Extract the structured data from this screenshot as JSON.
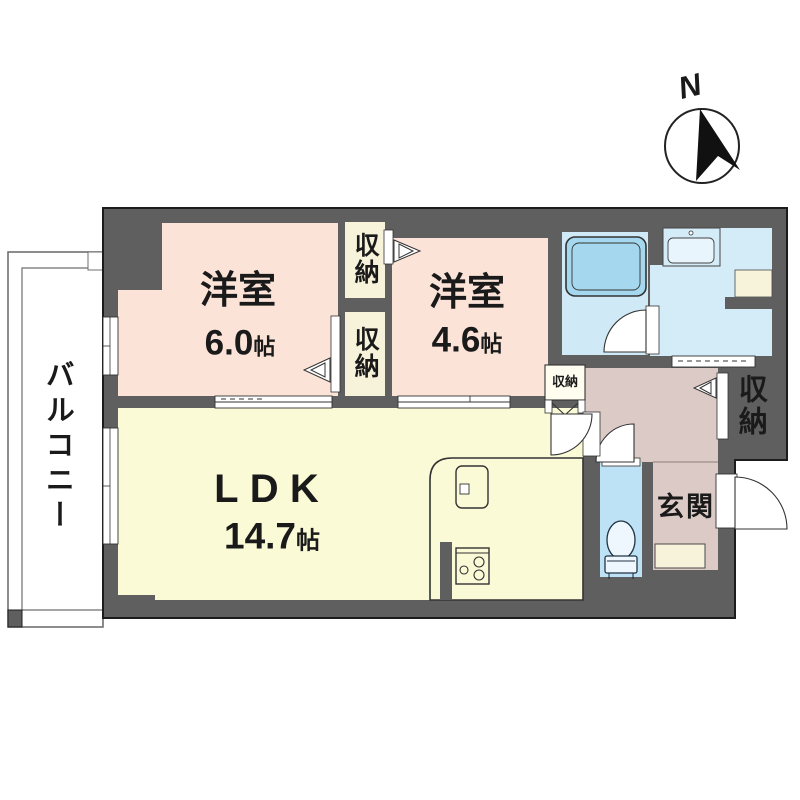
{
  "compass": {
    "label": "N"
  },
  "rooms": {
    "balcony": {
      "label": "バルコニー"
    },
    "bedroom_west_1": {
      "label": "洋室",
      "size": "6.0",
      "unit": "帖"
    },
    "bedroom_west_2": {
      "label": "洋室",
      "size": "4.6",
      "unit": "帖"
    },
    "ldk": {
      "label": "LDK",
      "size": "14.7",
      "unit": "帖"
    },
    "entrance": {
      "label": "玄関"
    },
    "closet_between_top": {
      "label": "収納"
    },
    "closet_between_bottom": {
      "label": "収納"
    },
    "closet_hallway_small": {
      "label": "収納"
    },
    "closet_entrance_side": {
      "label": "収納"
    }
  },
  "colors": {
    "wall": "#5f5f5f",
    "outline": "#1c1c1c",
    "bedroom_pink": "#fbe3d8",
    "ldk_yellow": "#fbfad6",
    "closet_cream": "#f6f3da",
    "bath_floor": "#cfe9f7",
    "bathtub": "#a5d8ee",
    "washroom_blue": "#d4ebf8",
    "toilet_blue": "#bde2f5",
    "hallway_mauve": "#dccac6"
  }
}
